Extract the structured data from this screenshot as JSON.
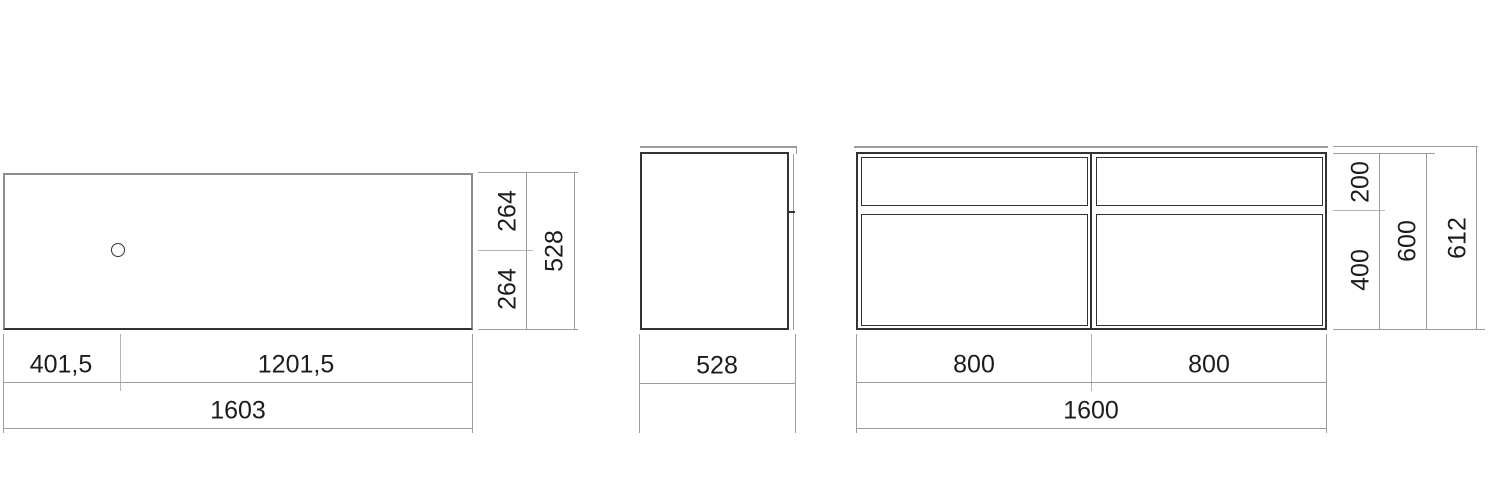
{
  "drawing": {
    "type": "furniture-dimension-drawing",
    "units": "mm",
    "colors": {
      "background": "#ffffff",
      "outline_dark": "#333333",
      "dimension_line": "#9c9c9c",
      "label_text": "#1c1c1c"
    },
    "views": {
      "top": {
        "name": "top view (plan with faucet hole)",
        "width_left": "401,5",
        "width_right": "1201,5",
        "width_total": "1603",
        "depth_upper": "264",
        "depth_lower": "264",
        "depth_total": "528"
      },
      "side": {
        "name": "side view",
        "depth_total": "528"
      },
      "front": {
        "name": "front view (2x2 drawers)",
        "width_left": "800",
        "width_right": "800",
        "width_total": "1600",
        "height_top_drawer": "200",
        "height_bottom_drawer": "400",
        "height_cabinet": "600",
        "height_overall": "612"
      }
    }
  }
}
